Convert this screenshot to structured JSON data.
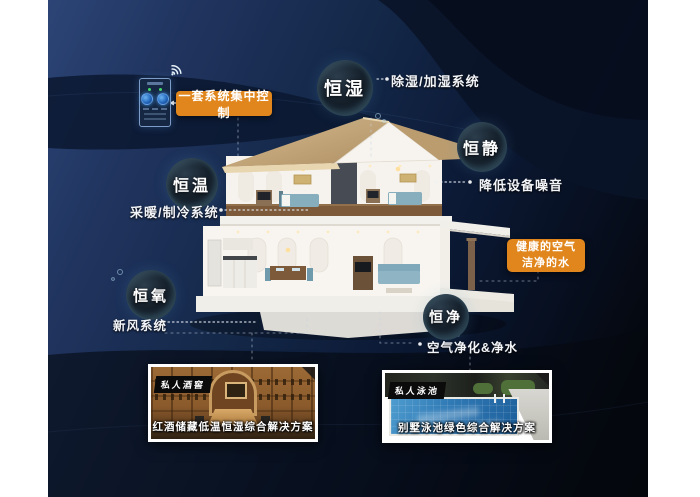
{
  "control_box": {
    "label": "一套系统集中控制"
  },
  "highlight_box": {
    "line1": "健康的空气",
    "line2": "洁净的水"
  },
  "bubbles": [
    {
      "label": "恒湿",
      "desc": "除湿/加湿系统"
    },
    {
      "label": "恒静",
      "desc": "降低设备噪音"
    },
    {
      "label": "恒温",
      "desc": "采暖/制冷系统"
    },
    {
      "label": "恒氧",
      "desc": "新风系统"
    },
    {
      "label": "恒净",
      "desc": "空气净化&净水"
    }
  ],
  "photos": [
    {
      "tag": "私人酒窖",
      "caption": "红酒储藏低温恒湿综合解决方案"
    },
    {
      "tag": "私人泳池",
      "caption": "别墅泳池绿色综合解决方案"
    }
  ],
  "colors": {
    "accent_orange": "#e0861c",
    "background_navy": "#16284a",
    "bubble_rim_glow": "#8fc8e0",
    "text_white": "#ffffff"
  }
}
